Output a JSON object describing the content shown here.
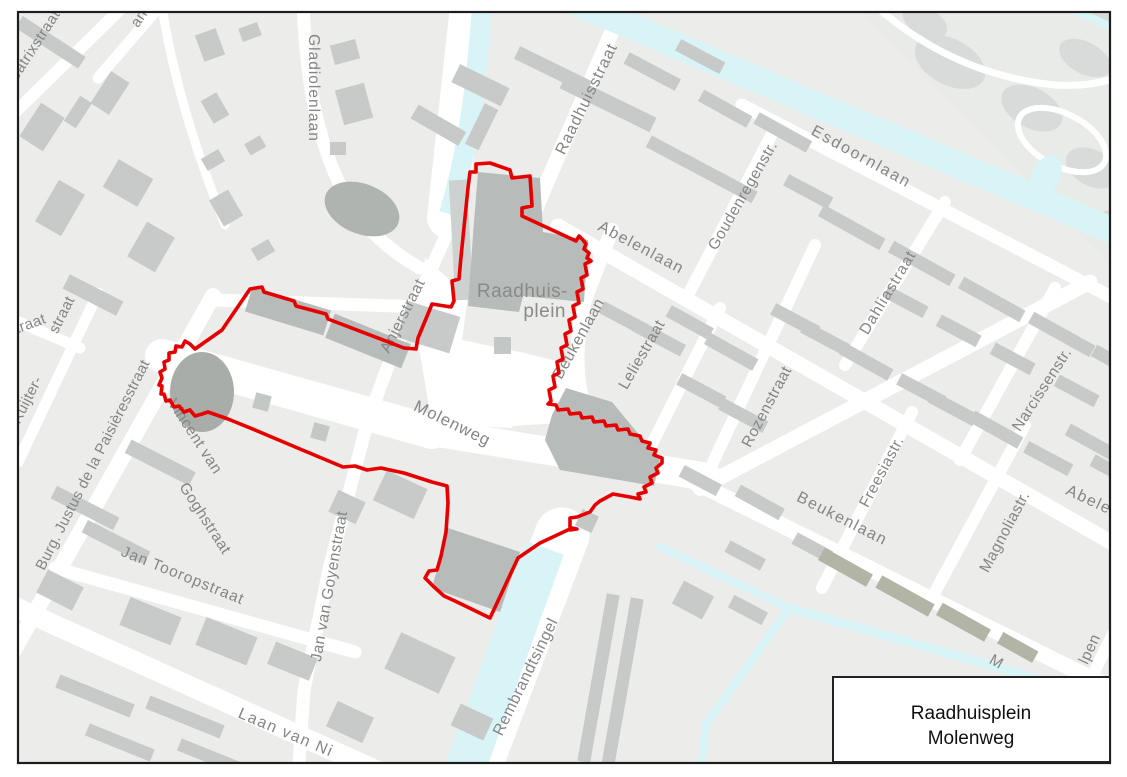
{
  "title_box": {
    "line1": "Raadhuisplein",
    "line2": "Molenweg"
  },
  "boundary": {
    "color": "#e60000",
    "stroke_width": 3.6,
    "points": "490,163 510,170 512,178 530,176 532,206 522,208 522,216 576,241 579,236 583,240 586,244 584,249 589,253 587,258 591,261 585,264 587,275 581,278 583,289 577,292 579,303 573,306 575,317 569,320 571,331 565,334 567,345 561,348 563,359 557,362 559,373 553,376 555,387 549,390 551,401 548,404 556,405 558,410 568,409 570,414 580,413 582,418 592,417 594,422 604,421 606,426 616,425 618,430 628,429 630,434 640,436 642,441 650,443 648,448 656,450 654,455 662,458 662,463 656,468 658,473 650,477 652,483 644,487 646,492 638,494 640,499 630,497 613,494 600,501 595,505 590,512 577,517 570,518 570,530 577,529 572,528 540,543 518,558 490,618 455,601 444,596 433,586 425,578 429,571 437,570 441,556 446,532 448,503 447,486 432,482 404,473 381,468 367,470 355,466 343,467 300,449 255,430 228,419 208,412 202,414 195,416 190,410 184,412 179,406 174,407 170,400 166,401 164,394 161,394 162,386 159,385 162,378 160,372 165,369 164,362 169,360 169,353 175,352 176,346 182,347 185,341 190,344 195,349 222,330 250,289 262,287 264,292 294,301 296,306 326,314 328,319 404,348 416,349 418,338 430,309 432,304 451,307 454,301 452,281 459,279 461,257 468,188 470,172 476,172 476,164"
  },
  "colors": {
    "map_background": "#ececeb",
    "street": "#ffffff",
    "water": "#d9f4f6",
    "building": "#c7cac8",
    "building_dark": "#b7bbb9",
    "building_olive": "#b2b4a5",
    "park": "#e9ebe9",
    "tree": "#d8dbd9",
    "label_gray": "#858585",
    "frame": "#1c1c1c"
  },
  "street_labels": [
    {
      "id": "beatrixstraat",
      "label": "Beatrixstraat",
      "x": 36,
      "y": 52,
      "rot": -57,
      "fs": 15,
      "ls": 0.5
    },
    {
      "id": "laan-fragment",
      "label": "an",
      "x": 143,
      "y": 21,
      "rot": -57,
      "fs": 15,
      "ls": 0.5
    },
    {
      "id": "gladiolenlaan",
      "label": "Gladiolenlaan",
      "x": 309,
      "y": 88,
      "rot": 90,
      "fs": 15.5,
      "ls": 1
    },
    {
      "id": "raadhuisstraat",
      "label": "Raadhuisstraat",
      "x": 591,
      "y": 101,
      "rot": -64,
      "fs": 16,
      "ls": 1
    },
    {
      "id": "esdoornlaan",
      "label": "Esdoornlaan",
      "x": 859,
      "y": 161,
      "rot": 29,
      "fs": 16,
      "ls": 2
    },
    {
      "id": "goudenregenstr",
      "label": "Goudenregenstr.",
      "x": 747,
      "y": 198,
      "rot": -60,
      "fs": 15.5,
      "ls": 0.5
    },
    {
      "id": "abelenlaan-west",
      "label": "Abelenlaan",
      "x": 639,
      "y": 252,
      "rot": 28,
      "fs": 16,
      "ls": 1.5
    },
    {
      "id": "dahliastraat",
      "label": "Dahliastraat",
      "x": 892,
      "y": 295,
      "rot": -59,
      "fs": 15.5,
      "ls": 1
    },
    {
      "id": "anjerstraat",
      "label": "Anjerstraat",
      "x": 407,
      "y": 318,
      "rot": -63,
      "fs": 15.5,
      "ls": 0.5
    },
    {
      "id": "raadhuisplein-line1",
      "label": "Raadhuis-",
      "x": 568,
      "y": 297,
      "rot": 0,
      "fs": 19,
      "ls": 0.5,
      "anchor": "end",
      "fill": "#8a8a8a"
    },
    {
      "id": "raadhuisplein-line2",
      "label": "plein",
      "x": 566,
      "y": 317,
      "rot": 0,
      "fs": 19,
      "ls": 0.5,
      "anchor": "end",
      "fill": "#8a8a8a"
    },
    {
      "id": "molenweg",
      "label": "Molenweg",
      "x": 450,
      "y": 428,
      "rot": 26,
      "fs": 16.5,
      "ls": 1
    },
    {
      "id": "beukenlaan-north",
      "label": "Beukenlaan",
      "x": 583,
      "y": 341,
      "rot": -61,
      "fs": 16,
      "ls": 0.5
    },
    {
      "id": "leliestraat",
      "label": "Leliestraat",
      "x": 646,
      "y": 357,
      "rot": -60,
      "fs": 15.5,
      "ls": 0.5
    },
    {
      "id": "rozenstraat",
      "label": "Rozenstraat",
      "x": 771,
      "y": 409,
      "rot": -62,
      "fs": 15.5,
      "ls": 0.5
    },
    {
      "id": "narcissenstr",
      "label": "Narcissenstr.",
      "x": 1046,
      "y": 392,
      "rot": -57,
      "fs": 15.5,
      "ls": 0.5
    },
    {
      "id": "freesiastr",
      "label": "Freesiastr.",
      "x": 886,
      "y": 474,
      "rot": -62,
      "fs": 15.5,
      "ls": 0.5
    },
    {
      "id": "beukenlaan-east",
      "label": "Beukenlaan",
      "x": 840,
      "y": 523,
      "rot": 27,
      "fs": 16,
      "ls": 1.5
    },
    {
      "id": "magnoliastr",
      "label": "Magnoliastr.",
      "x": 1009,
      "y": 534,
      "rot": -62,
      "fs": 15.5,
      "ls": 0.5
    },
    {
      "id": "abelenlaan-east",
      "label": "Abelenlaan",
      "x": 1108,
      "y": 514,
      "rot": 25,
      "fs": 16,
      "ls": 1.5
    },
    {
      "id": "vincent-van-goghstraat-line1",
      "label": "Vincent van",
      "x": 191,
      "y": 439,
      "rot": 57,
      "fs": 15.5,
      "ls": 0.5
    },
    {
      "id": "vincent-van-goghstraat-line2",
      "label": "Goghstraat",
      "x": 201,
      "y": 521,
      "rot": 57,
      "fs": 15.5,
      "ls": 0.5
    },
    {
      "id": "burg-justus-de-la-paisieresstraat",
      "label": "Burg. Justus de la Paisièresstraat",
      "x": 97,
      "y": 467,
      "rot": -63,
      "fs": 15,
      "ls": 0.3
    },
    {
      "id": "ruijter-fragment",
      "label": "Ruijter-",
      "x": 31,
      "y": 402,
      "rot": -63,
      "fs": 15,
      "ls": 0.3
    },
    {
      "id": "ruijter-straat-fragment",
      "label": "straat",
      "x": 66,
      "y": 317,
      "rot": -63,
      "fs": 15,
      "ls": 0.3
    },
    {
      "id": "straat-fragment",
      "label": "traat",
      "x": 32,
      "y": 328,
      "rot": -20,
      "fs": 15,
      "ls": 0.3
    },
    {
      "id": "jan-tooropstraat",
      "label": "Jan Tooropstraat",
      "x": 181,
      "y": 580,
      "rot": 22,
      "fs": 15.5,
      "ls": 1
    },
    {
      "id": "jan-van-goyenstraat",
      "label": "Jan van Goyenstraat",
      "x": 334,
      "y": 587,
      "rot": -80,
      "fs": 15.5,
      "ls": 0.5
    },
    {
      "id": "rembrandtsingel",
      "label": "Rembrandtsingel",
      "x": 530,
      "y": 679,
      "rot": -64,
      "fs": 16,
      "ls": 0.5
    },
    {
      "id": "laan-van-n",
      "label": "Laan van Ni",
      "x": 284,
      "y": 737,
      "rot": 23,
      "fs": 16,
      "ls": 1.5
    },
    {
      "id": "m-fragment",
      "label": "M",
      "x": 994,
      "y": 666,
      "rot": 30,
      "fs": 15.5,
      "ls": 0.5
    },
    {
      "id": "lpen-fragment",
      "label": "lpen",
      "x": 1094,
      "y": 651,
      "rot": -65,
      "fs": 15.5,
      "ls": 0.5
    }
  ]
}
